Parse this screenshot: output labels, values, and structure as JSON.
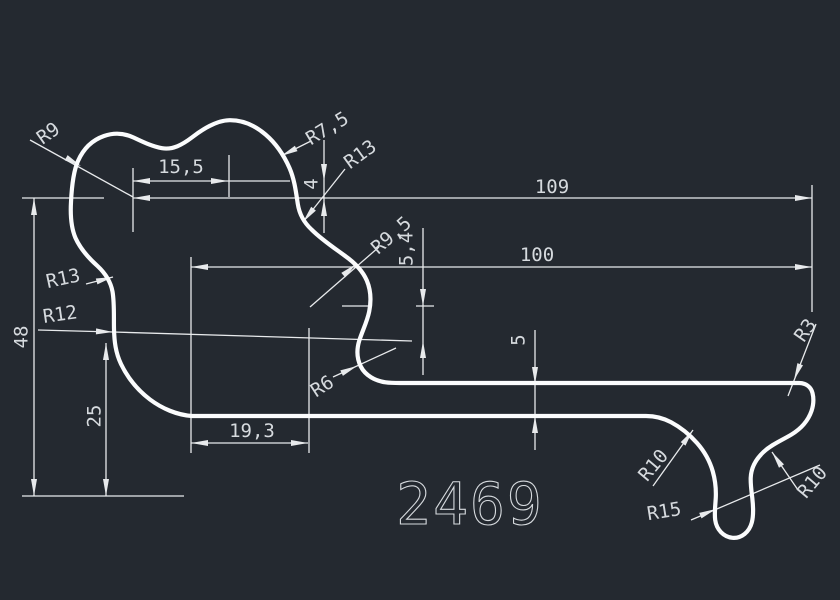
{
  "colors": {
    "background": "#242930",
    "line": "#e8eaec",
    "profile": "#fbfcfd",
    "text": "#d6dade"
  },
  "drawing": {
    "part_number": "2469",
    "dimensions": {
      "width_total": "109",
      "width_body": "100",
      "height_total": "48",
      "height_lower": "25",
      "top_offset": "15,5",
      "step": "4",
      "web": "5,4",
      "thickness": "5",
      "bottom_offset": "19,3"
    },
    "radii": {
      "r9": "R9",
      "r7_5": "R7,5",
      "r13_top": "R13",
      "r9_5": "R9,5",
      "r13_left": "R13",
      "r12": "R12",
      "r6": "R6",
      "r3": "R3",
      "r10_left": "R10",
      "r10_right": "R10",
      "r15": "R15"
    }
  }
}
